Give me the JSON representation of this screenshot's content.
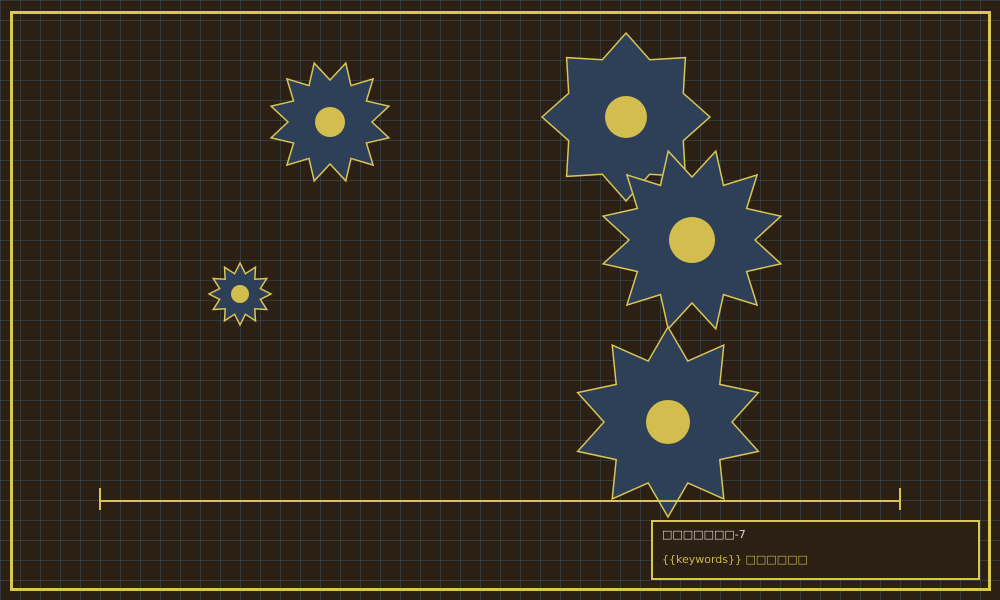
{
  "canvas": {
    "background": "#2b2013",
    "grid_line_color": "rgba(70,120,150,0.30)",
    "grid_cell_size": 20,
    "frame_color": "#d9c84f"
  },
  "star_style": {
    "fill": "#2d4057",
    "stroke": "#d9c455",
    "stroke_width": 1.5,
    "core_fill": "#d2bd4e"
  },
  "stars": [
    {
      "name": "gear-small-left",
      "cx": 240,
      "cy": 294,
      "outer_r": 31,
      "inner_r": 21,
      "points": 12,
      "rotation": -90,
      "core_r": 9
    },
    {
      "name": "gear-top-left",
      "cx": 330,
      "cy": 122,
      "outer_r": 61,
      "inner_r": 42,
      "points": 12,
      "rotation": -75,
      "core_r": 15
    },
    {
      "name": "gear-top-right",
      "cx": 626,
      "cy": 117,
      "outer_r": 84,
      "inner_r": 62,
      "points": 8,
      "rotation": -90,
      "core_r": 21
    },
    {
      "name": "gear-middle-right",
      "cx": 692,
      "cy": 240,
      "outer_r": 92,
      "inner_r": 63,
      "points": 12,
      "rotation": -75,
      "core_r": 23
    },
    {
      "name": "gear-bottom-right",
      "cx": 668,
      "cy": 422,
      "outer_r": 95,
      "inner_r": 64,
      "points": 10,
      "rotation": -90,
      "core_r": 22
    }
  ],
  "scale_bar": {
    "x1": 100,
    "x2": 900,
    "y": 501,
    "tick_top": 488,
    "tick_bottom": 510,
    "color": "#d9c455",
    "thickness": 2
  },
  "info_box": {
    "title": "□□□□□□□-7",
    "subtitle": "{{keywords}} □□□□□□",
    "title_color": "#d9d9d9",
    "subtitle_color": "#c9b94d",
    "border_color": "#d9c84f"
  }
}
